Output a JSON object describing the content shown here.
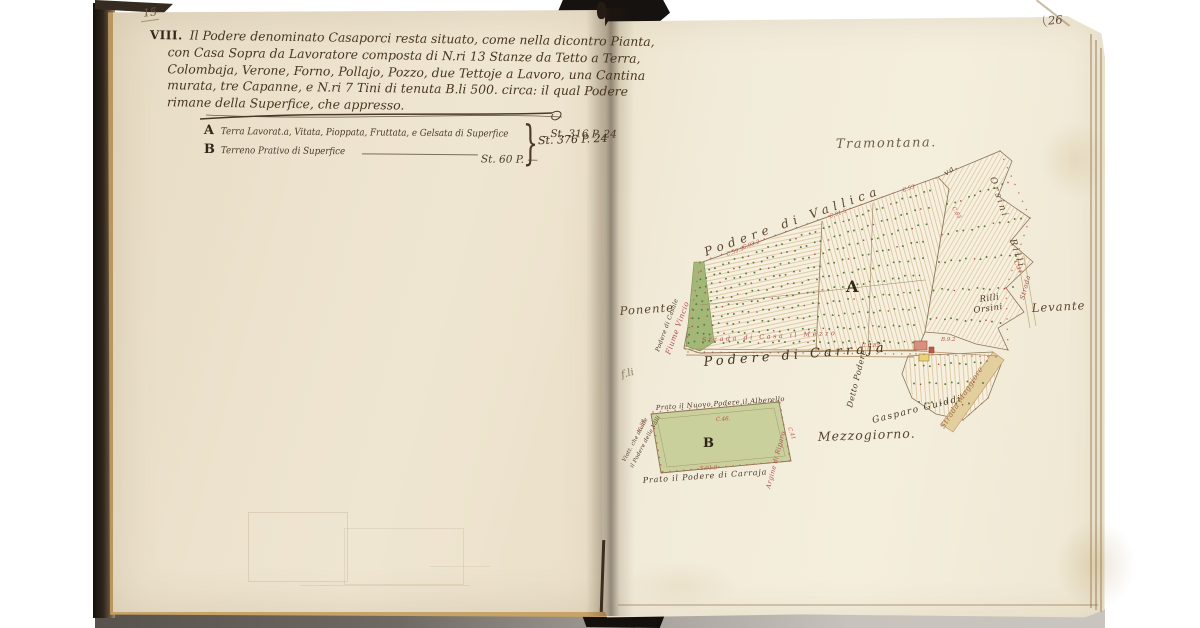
{
  "left_page": {
    "page_number": "15",
    "section_numeral": "VIII.",
    "paragraph_lines": [
      "Il Podere denominato Casaporci resta situato, come nella dicontro Pianta,",
      "con Casa Sopra da Lavoratore composta di N.ri 13 Stanze da Tetto a Terra,",
      "Colombaja, Verone, Forno, Pollajo, Pozzo, due Tettoje a Lavoro, una Cantina",
      "murata, tre Capanne, e N.ri 7 Tini di tenuta B.li 500. circa: il qual Podere",
      "rimane della Superfice, che appresso."
    ],
    "entries": [
      {
        "key": "A",
        "text": "Terra Lavorat.a, Vitata, Pioppata, Fruttata, e Gelsata di Superfice",
        "value": "St. 316 P. 24"
      },
      {
        "key": "B",
        "text": "Terreno Prativo di Superfice",
        "value": "St. 60 P. —"
      }
    ],
    "brace": "}",
    "total_value": "St. 376 P. 24"
  },
  "right_page": {
    "page_number": "26"
  },
  "map": {
    "colors": {
      "ink": "#4a3929",
      "red_ink": "#b05050",
      "parcel_fill": "#f7f0de",
      "meadow_green": "#c9d09c",
      "river_green": "#a3b878",
      "tree_green": "#567b3a",
      "tree_red": "#a84c44",
      "road_tan": "#b1946a"
    },
    "labels": [
      {
        "id": "tramontana",
        "text": "Tramontana.",
        "x": 836,
        "y": 148,
        "rot": -1,
        "size": 13,
        "color": "#6f5e46",
        "ls": 1.5
      },
      {
        "id": "podere-di-vallica",
        "text": "Podere di Vallica",
        "x": 706,
        "y": 256,
        "rot": -19.5,
        "size": 12,
        "color": "#5a452e",
        "ls": 5
      },
      {
        "id": "va",
        "text": "va.",
        "x": 946,
        "y": 176,
        "rot": -35,
        "size": 8,
        "color": "#5a452e",
        "ls": 1
      },
      {
        "id": "orsini-edge",
        "text": "Orsini",
        "x": 990,
        "y": 178,
        "rot": 72,
        "size": 9,
        "color": "#5a452e",
        "ls": 2.5
      },
      {
        "id": "rilli-edge",
        "text": "Rilli",
        "x": 1010,
        "y": 240,
        "rot": 72,
        "size": 9,
        "color": "#5a452e",
        "ls": 2.5
      },
      {
        "id": "rilli",
        "text": "Rilli",
        "x": 980,
        "y": 302,
        "rot": -8,
        "size": 8.5,
        "color": "#4a3a28",
        "ls": 0.5
      },
      {
        "id": "orsini",
        "text": "Orsini",
        "x": 974,
        "y": 313,
        "rot": -8,
        "size": 8.5,
        "color": "#4a3a28",
        "ls": 0.5
      },
      {
        "id": "strada-small",
        "text": "Strada",
        "x": 1024,
        "y": 300,
        "rot": -75,
        "size": 6.5,
        "color": "#a05545",
        "ls": 0.5
      },
      {
        "id": "levante",
        "text": "Levante",
        "x": 1032,
        "y": 312,
        "rot": -3,
        "size": 11.5,
        "color": "#5a452e",
        "ls": 1
      },
      {
        "id": "ponente",
        "text": "Ponente",
        "x": 620,
        "y": 315,
        "rot": -4,
        "size": 11.5,
        "color": "#5a452e",
        "ls": 1
      },
      {
        "id": "podere-di-casale",
        "text": "Podere di Casale",
        "x": 659,
        "y": 352,
        "rot": -70,
        "size": 6,
        "color": "#4a3a28",
        "ls": 0.3
      },
      {
        "id": "fiume-vincio",
        "text": "Fiume Vincio",
        "x": 670,
        "y": 355,
        "rot": -70,
        "size": 7.5,
        "color": "#b05050",
        "ls": 0.5
      },
      {
        "id": "strada-di-mezzo",
        "text": "Strada di Casa il Mezzo",
        "x": 702,
        "y": 342,
        "rot": -3,
        "size": 6.5,
        "color": "#b05050",
        "ls": 2.5
      },
      {
        "id": "podere-di-carraja",
        "text": "Podere di Carrajà",
        "x": 704,
        "y": 366,
        "rot": -4.5,
        "size": 13,
        "color": "#43311f",
        "ls": 4
      },
      {
        "id": "detto-podere",
        "text": "Detto Podere",
        "x": 852,
        "y": 408,
        "rot": -76,
        "size": 8,
        "color": "#4a3a28",
        "ls": 0.5
      },
      {
        "id": "gasparo-guiddi",
        "text": "Gasparo Guiddi",
        "x": 873,
        "y": 423,
        "rot": -14,
        "size": 9,
        "color": "#4a3a28",
        "ls": 1.5
      },
      {
        "id": "strada-maggiore",
        "text": "Strada Maggiore",
        "x": 944,
        "y": 429,
        "rot": -57,
        "size": 7.5,
        "color": "#a0704a",
        "ls": 0.5
      },
      {
        "id": "mezzogiorno",
        "text": "Mezzogiorno.",
        "x": 818,
        "y": 441,
        "rot": -2,
        "size": 12.5,
        "color": "#5a452e",
        "ls": 1
      },
      {
        "id": "prato-nuovo",
        "text": "Prato il Nuovo Podere il Alberello",
        "x": 656,
        "y": 410,
        "rot": -4,
        "size": 6.8,
        "color": "#4a3a28",
        "ls": 0.4
      },
      {
        "id": "prato-carraja",
        "text": "Prato il Podere di Carraja",
        "x": 643,
        "y": 483,
        "rot": -4,
        "size": 8,
        "color": "#4a3a28",
        "ls": 0.8
      },
      {
        "id": "argine",
        "text": "Argine di Riparo",
        "x": 770,
        "y": 489,
        "rot": -75,
        "size": 6.5,
        "color": "#b05050",
        "ls": 0.3
      },
      {
        "id": "viottolo-1",
        "text": "Viott. che divide",
        "x": 625,
        "y": 462,
        "rot": -62,
        "size": 5.5,
        "color": "#4a3a28",
        "ls": 0.2
      },
      {
        "id": "viottolo-2",
        "text": "il Podere delle Valli",
        "x": 633,
        "y": 468,
        "rot": -62,
        "size": 5.5,
        "color": "#4a3a28",
        "ls": 0.2
      },
      {
        "id": "scribble",
        "text": "f.li",
        "x": 622,
        "y": 378,
        "rot": -15,
        "size": 10,
        "color": "#8a7a60",
        "ls": 0
      },
      {
        "id": "plot-a-letter",
        "text": "A",
        "x": 846,
        "y": 292,
        "rot": 0,
        "size": 16,
        "color": "#2f2416",
        "ls": 0,
        "bold": true
      },
      {
        "id": "plot-b-letter",
        "text": "B",
        "x": 703,
        "y": 447,
        "rot": 0,
        "size": 13,
        "color": "#2f2416",
        "ls": 0,
        "bold": true
      }
    ],
    "edge_marks": [
      {
        "text": "C.93.2",
        "x": 743,
        "y": 249,
        "rot": -19
      },
      {
        "text": "C.91.5",
        "x": 830,
        "y": 218,
        "rot": -19
      },
      {
        "text": "C.59.3",
        "x": 727,
        "y": 256,
        "rot": -19
      },
      {
        "text": "C.53",
        "x": 903,
        "y": 192,
        "rot": -19
      },
      {
        "text": "C.83",
        "x": 952,
        "y": 208,
        "rot": 60
      },
      {
        "text": "C.44",
        "x": 1014,
        "y": 262,
        "rot": 65
      },
      {
        "text": "B.9.2",
        "x": 941,
        "y": 341,
        "rot": 0
      },
      {
        "text": "C.6.83",
        "x": 862,
        "y": 347,
        "rot": 0
      },
      {
        "text": "C.46.",
        "x": 716,
        "y": 421,
        "rot": -3
      },
      {
        "text": "S.91.9",
        "x": 700,
        "y": 470,
        "rot": -3
      },
      {
        "text": "C.39",
        "x": 641,
        "y": 432,
        "rot": -70
      },
      {
        "text": "C.41",
        "x": 788,
        "y": 428,
        "rot": 70
      }
    ]
  }
}
